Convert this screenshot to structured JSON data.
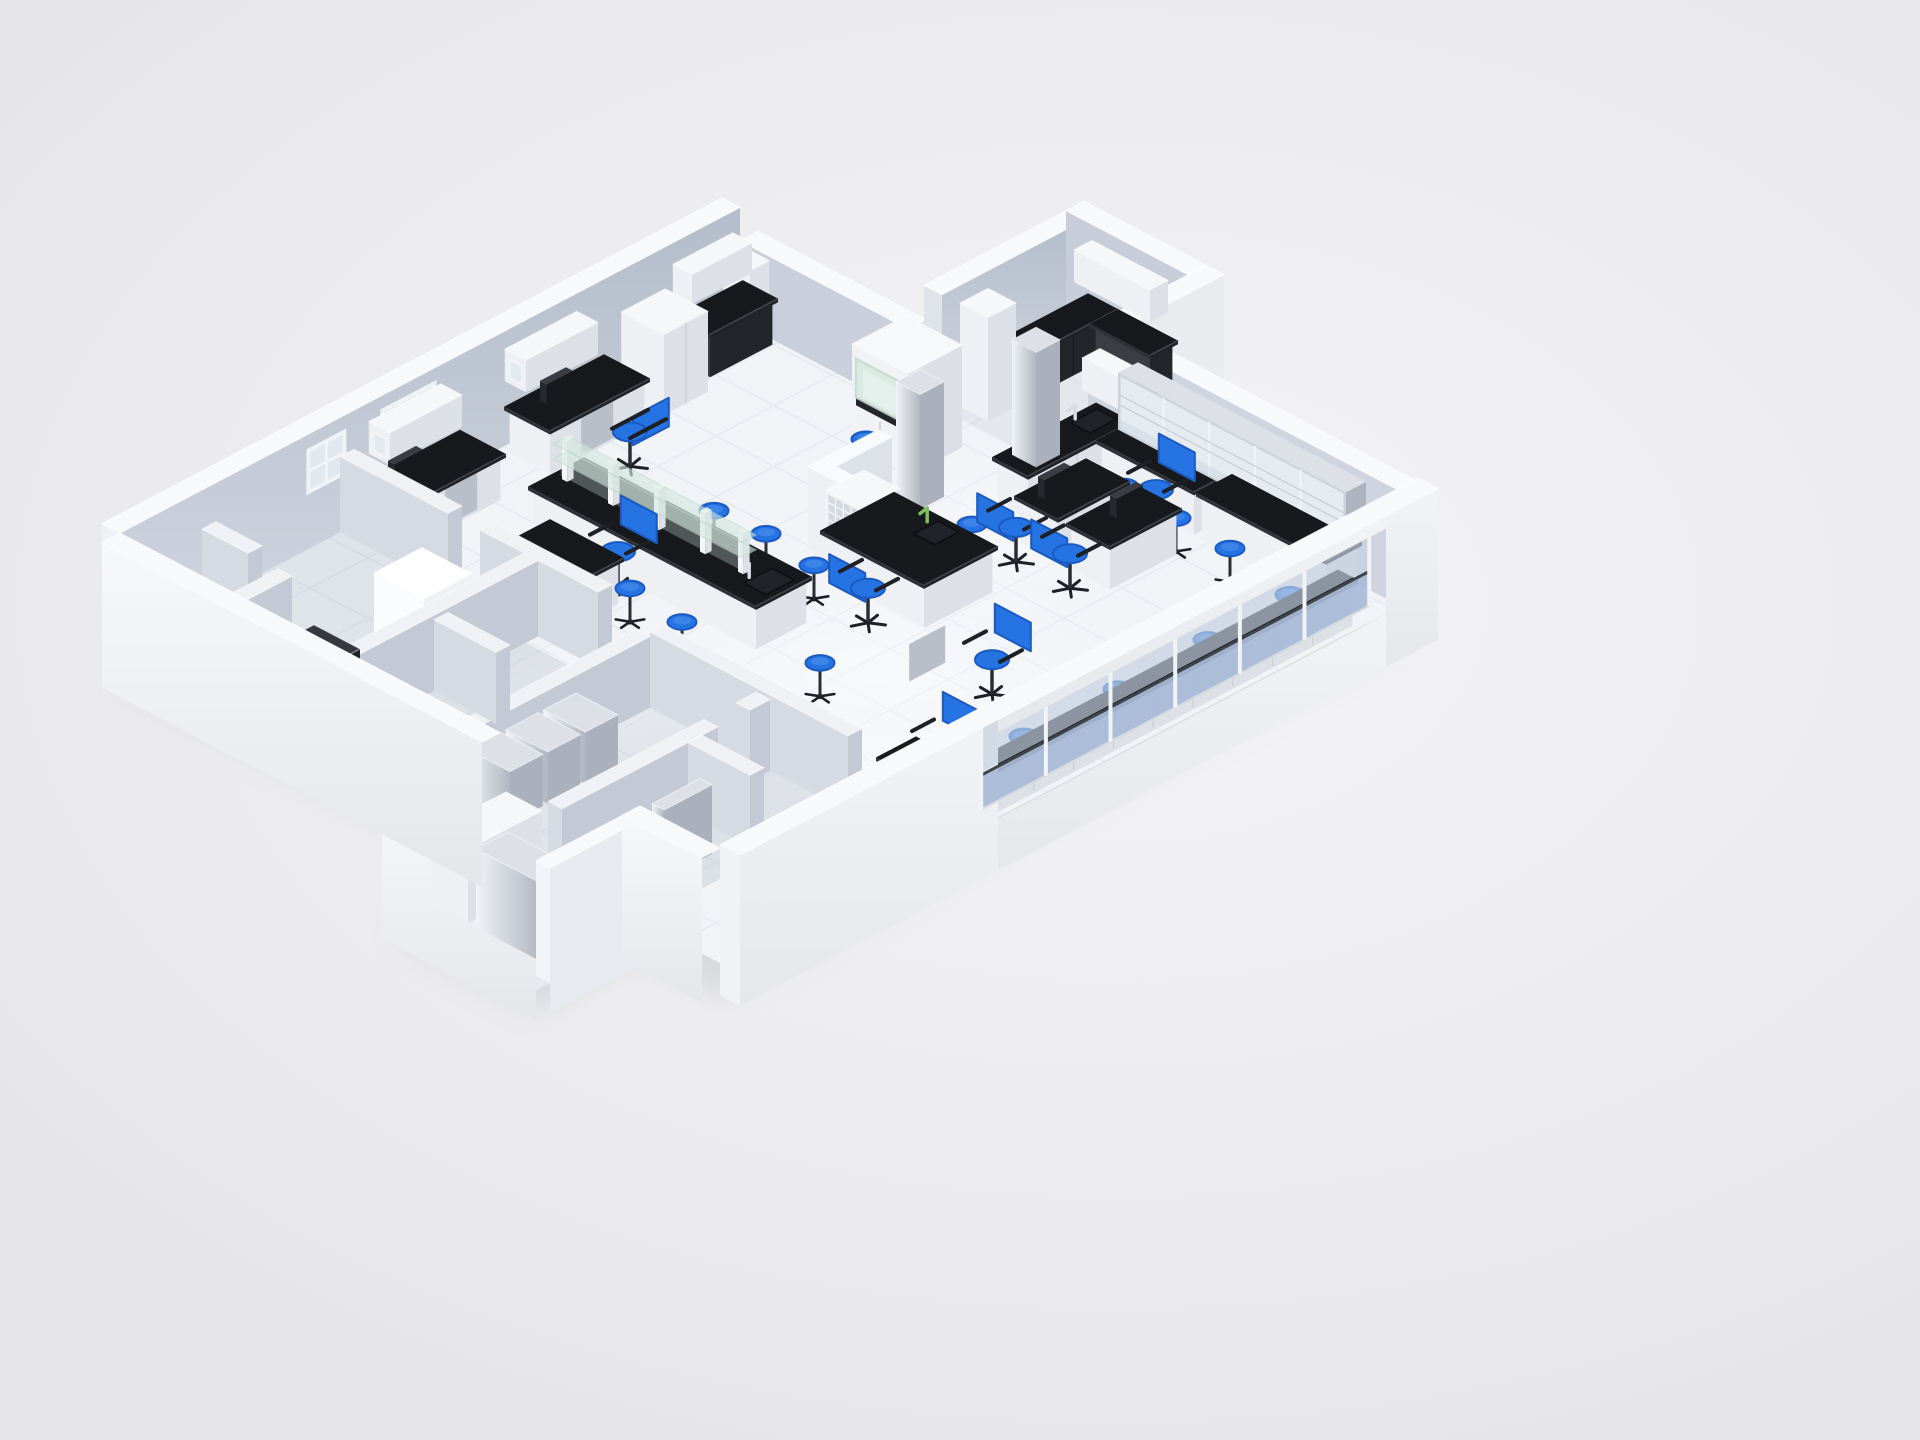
{
  "meta": {
    "title": "3D isometric laboratory floor plan render",
    "description": "Cutaway axonometric rendering of a laboratory: white outer walls, blue-gray partition walls, white tiled floor, black-top lab benches with white cabinets, central island with glass reagent shelf, fume hood, blue task chairs and blue round stools, glass curtain wall along the front facade, glass-door cabinet wall on the right."
  },
  "palette": {
    "bg": "#ededef",
    "shadow": "#c7c9ce",
    "floor": "#f1f3f7",
    "tile": "#e3e7ef",
    "wallTop": "#f8f9fb",
    "wallInnerA": "#b4bdcb",
    "wallInnerB": "#d0d6e0",
    "wallInnerNE": "#cfd5e0",
    "wallOuterBright": "#f5f6f8",
    "wallOuterShade": "#e4e7ec",
    "partU": "#d6dbe3",
    "partV": "#c3cad5",
    "partTop": "#eff1f5",
    "cabU": "#eef0f3",
    "cabV": "#dde1e7",
    "cabTop": "#f5f7f9",
    "cabLine": "#c9cdd4",
    "counterTop": "#17191c",
    "counterU": "#2e3237",
    "counterV": "#1f2226",
    "darkBase": "#33373d",
    "blue": "#2673e3",
    "blueDark": "#1b5ac0",
    "blueLight": "#5b99f0",
    "black": "#1d2024",
    "metalU": "#e9edf2",
    "metalV": "#aab1bc",
    "metalTop": "#dde0e6",
    "glassGreen": "#d6e9e0",
    "glassGreenEdge": "#bcd8cc",
    "glassUpper": "#c3cedf",
    "glassLower": "#a8bad7",
    "railDark": "#3f444b",
    "mullion": "#f1f3f6",
    "windowPane": "#e2ebf2",
    "red": "#c03a2b",
    "faucetGreen": "#7cc15a"
  },
  "iso": {
    "origin": [
      120,
      648
    ],
    "ax": 40,
    "ay": 21,
    "hz": 23
  },
  "scene": {
    "floor_outline": [
      [
        0,
        0
      ],
      [
        15.5,
        0
      ],
      [
        15.5,
        4.2
      ],
      [
        19.5,
        4.2
      ],
      [
        19.5,
        7.2
      ],
      [
        17,
        7.2
      ],
      [
        17,
        15
      ],
      [
        0,
        15
      ],
      [
        0,
        13
      ],
      [
        -2.6,
        13
      ],
      [
        -2.6,
        9.5
      ],
      [
        0,
        9.5
      ]
    ],
    "tile_step": 1.45,
    "room_shade": [
      {
        "n": "room-upper-left",
        "bb": [
          0,
          0,
          5.5,
          4.6
        ],
        "op": 0.2
      },
      {
        "n": "room-mid-left",
        "bb": [
          0,
          4.95,
          5.2,
          7.7
        ],
        "op": 0.24
      },
      {
        "n": "room-low-left-a",
        "bb": [
          0,
          8.05,
          5.2,
          10.7
        ],
        "op": 0.18
      },
      {
        "n": "room-low-left-b",
        "bb": [
          0,
          11.05,
          5.2,
          13.0
        ],
        "op": 0.24
      },
      {
        "n": "block-room",
        "bb": [
          -2.6,
          9.85,
          0,
          13.0
        ],
        "op": 0.22
      },
      {
        "n": "wing-room",
        "bb": [
          15.95,
          4.6,
          19.5,
          7.2
        ],
        "op": 0.14
      }
    ],
    "light_patches": [
      {
        "u": 4.6,
        "v": 7.1,
        "rx": 130,
        "ry": 60,
        "op": 0.65
      },
      {
        "u": 8.8,
        "v": 10.2,
        "rx": 300,
        "ry": 120,
        "op": 0.5
      },
      {
        "u": 13.5,
        "v": 8.2,
        "rx": 230,
        "ry": 95,
        "op": 0.32
      },
      {
        "u": 6.4,
        "v": 12.6,
        "rx": 150,
        "ry": 65,
        "op": 0.5
      }
    ],
    "walls_back": [
      {
        "n": "nw-wall",
        "bb": [
          0,
          -0.45,
          15.5,
          0
        ],
        "h": 5,
        "inner": "V",
        "fill": "GRADWALL",
        "capU0out": true
      },
      {
        "n": "notch-step-wall",
        "bb": [
          15.5,
          0,
          15.95,
          4.2
        ],
        "h": 3.55,
        "inner": "U",
        "fill": "#c9d0db",
        "capVend": "#dde1e7"
      },
      {
        "n": "wing-back-wall",
        "bb": [
          15.95,
          4.15,
          19.5,
          4.6
        ],
        "h": 5,
        "inner": "V",
        "fill": "GRADWALL",
        "capU0": "#e0e4ea"
      },
      {
        "n": "wing-far-wall",
        "bb": [
          19.5,
          4.15,
          19.95,
          7.65
        ],
        "h": 5,
        "inner": "U",
        "fill": "#c7ceda"
      },
      {
        "n": "wing-right-wall",
        "bb": [
          17.45,
          7.2,
          19.95,
          7.65
        ],
        "h": 5,
        "outerV": "#e9ebef",
        "capU0": "#dfe3e9"
      },
      {
        "n": "ne-wall",
        "bb": [
          17,
          7.2,
          17.45,
          15
        ],
        "h": 5,
        "inner": "U",
        "fill": "#cfd5e0",
        "capVend": "#e4e7ec"
      },
      {
        "n": "block-back-wall",
        "bb": [
          -2.6,
          9.5,
          0,
          9.85
        ],
        "h": 5,
        "inner": "V",
        "fill": "#c6cdd8"
      },
      {
        "n": "block-far-wall",
        "bb": [
          -2.95,
          9.5,
          -2.6,
          13.35
        ],
        "h": 5,
        "outerU": "GRADOUT",
        "capVend": "#e6e9ed"
      }
    ],
    "windows": [
      {
        "n": "nw-window-1",
        "u0": 4.7,
        "u1": 5.6,
        "h0": 2.5,
        "h1": 4.3,
        "cols": 2,
        "rows": 2
      },
      {
        "n": "nw-window-2",
        "u0": 6.55,
        "u1": 7.85,
        "h0": 2.55,
        "h1": 4.35,
        "cols": 3,
        "rows": 2
      },
      {
        "n": "alcove-window",
        "u0": 14.05,
        "u1": 14.75,
        "h0": 2.7,
        "h1": 3.9,
        "cols": 1,
        "rows": 1
      }
    ],
    "ne_monitor": {
      "v0": 7.5,
      "v1": 8.05,
      "h0": 3.35,
      "h1": 3.95
    },
    "items": [
      {
        "n": "partition-a",
        "t": "part",
        "bb": [
          0,
          4.6,
          5.5,
          4.95
        ],
        "h": 3.3
      },
      {
        "n": "partition-b1",
        "t": "part",
        "bb": [
          5.5,
          0,
          5.85,
          2.7
        ],
        "h": 3.3
      },
      {
        "n": "partition-b2",
        "t": "part",
        "bb": [
          5.5,
          3.5,
          5.85,
          6.45
        ],
        "h": 3.3
      },
      {
        "n": "partition-c",
        "t": "part",
        "bb": [
          0,
          7.7,
          5.2,
          8.05
        ],
        "h": 3.1
      },
      {
        "n": "partition-d",
        "t": "part",
        "bb": [
          5.2,
          8.05,
          5.55,
          13.0
        ],
        "h": 3.3
      },
      {
        "n": "partition-e1",
        "t": "part",
        "bb": [
          0,
          10.7,
          3.9,
          11.05
        ],
        "h": 3.1
      },
      {
        "n": "partition-e2",
        "t": "part",
        "bb": [
          4.7,
          10.7,
          5.2,
          11.05
        ],
        "h": 3.1
      },
      {
        "n": "partition-f",
        "t": "part",
        "bb": [
          2.9,
          4.95,
          3.25,
          6.5
        ],
        "h": 3.1
      },
      {
        "n": "partition-g",
        "t": "part",
        "bb": [
          3.15,
          11.05,
          3.5,
          12.6
        ],
        "h": 3.1
      },
      {
        "n": "partition-h",
        "t": "part",
        "bb": [
          2.05,
          0,
          2.4,
          1.15
        ],
        "h": 3.3
      },
      {
        "n": "partition-i",
        "t": "part",
        "bb": [
          0,
          1.9,
          2.05,
          2.25
        ],
        "h": 3.3
      },
      {
        "n": "tall-cabinet-left",
        "t": "box",
        "bb": [
          3.05,
          3.3,
          4.25,
          4.55
        ],
        "h": 3.5,
        "c": "bright"
      },
      {
        "n": "dark-equipment",
        "t": "box",
        "bb": [
          0.55,
          3.35,
          1.5,
          4.5
        ],
        "h": 2.7,
        "c": "dark",
        "reddot": true
      },
      {
        "n": "silver-cabinet-1",
        "t": "box",
        "bb": [
          0.7,
          8.0,
          1.52,
          9.05
        ],
        "h": 2.25,
        "c": "metal"
      },
      {
        "n": "silver-cabinet-2",
        "t": "box",
        "bb": [
          1.64,
          8.0,
          2.46,
          9.05
        ],
        "h": 2.25,
        "c": "metal"
      },
      {
        "n": "silver-cabinet-3",
        "t": "box",
        "bb": [
          2.58,
          8.0,
          3.4,
          9.05
        ],
        "h": 2.25,
        "c": "metal"
      },
      {
        "n": "leaning-panel-1",
        "t": "box",
        "bb": [
          2.1,
          11.0,
          3.3,
          11.3
        ],
        "h": 3.3,
        "c": "metal"
      },
      {
        "n": "leaning-panel-2",
        "t": "box",
        "bb": [
          1.3,
          12.0,
          2.5,
          12.3
        ],
        "h": 3.0,
        "c": "metal"
      },
      {
        "n": "gray-box",
        "t": "box",
        "bb": [
          0.4,
          5.2,
          1.2,
          6.2
        ],
        "h": 1.9,
        "c": "dark"
      },
      {
        "n": "block-cabinet-1",
        "t": "box",
        "bb": [
          -2.2,
          10.0,
          -0.35,
          10.9
        ],
        "h": 3.2,
        "c": "white"
      },
      {
        "n": "block-cabinet-2",
        "t": "box",
        "bb": [
          -2.2,
          11.1,
          -1.4,
          12.7
        ],
        "h": 3.4,
        "c": "metal"
      },
      {
        "n": "wall-bench-a",
        "t": "counter",
        "bb": [
          5.9,
          0.15,
          8.35,
          1.3
        ],
        "monitor": [
          6.25,
          0.45,
          6.95,
          0.62
        ],
        "gap": [
          6.9,
          7.7
        ]
      },
      {
        "n": "wall-bench-b",
        "t": "counter",
        "bb": [
          9.45,
          0.15,
          11.95,
          1.3
        ],
        "monitor": [
          10.05,
          0.45,
          10.7,
          0.62
        ],
        "gap": [
          10.3,
          11.1
        ]
      },
      {
        "n": "upper-cabinet-1",
        "t": "box",
        "bb": [
          6.2,
          0.02,
          8.0,
          0.55
        ],
        "h": 4.2,
        "z0": 2.8,
        "c": "white",
        "frost": true
      },
      {
        "n": "upper-cabinet-2",
        "t": "box",
        "bb": [
          9.6,
          0.02,
          11.4,
          0.55
        ],
        "h": 4.25,
        "z0": 2.85,
        "c": "white",
        "frost": true
      },
      {
        "n": "upper-cabinet-3",
        "t": "box",
        "bb": [
          13.8,
          0.02,
          15.3,
          0.5
        ],
        "h": 4.1,
        "z0": 2.8,
        "c": "white"
      },
      {
        "n": "tall-cabinet-2",
        "t": "box",
        "bb": [
          12.35,
          0.18,
          13.45,
          1.25
        ],
        "h": 3.5,
        "c": "white",
        "seam": true
      },
      {
        "n": "alcove-counter",
        "t": "counter",
        "bb": [
          13.75,
          0.12,
          15.45,
          1.0
        ],
        "dark": true
      },
      {
        "n": "alcove-pillar",
        "t": "box",
        "bb": [
          15.0,
          0.08,
          15.48,
          0.75
        ],
        "h": 3.4,
        "c": "white"
      },
      {
        "n": "fume-hood",
        "t": "hood",
        "bb": [
          13.95,
          4.35,
          15.3,
          5.75
        ],
        "h": 4.45
      },
      {
        "n": "column-1",
        "t": "box",
        "bb": [
          13.3,
          6.1,
          13.9,
          6.7
        ],
        "h": 5,
        "c": "metal"
      },
      {
        "n": "column-2",
        "t": "box",
        "bb": [
          15.75,
          6.55,
          16.35,
          7.15
        ],
        "h": 5,
        "c": "metal"
      },
      {
        "n": "white-column-cabinet",
        "t": "box",
        "bb": [
          16.25,
          4.75,
          16.95,
          5.45
        ],
        "h": 4.5,
        "c": "white"
      },
      {
        "n": "l-partition-1",
        "t": "part",
        "bb": [
          10.95,
          6.25,
          11.3,
          8.7
        ],
        "h": 3.6,
        "bright": true
      },
      {
        "n": "l-partition-2",
        "t": "part",
        "bb": [
          10.95,
          6.25,
          12.7,
          6.6
        ],
        "h": 3.6,
        "bright": true
      },
      {
        "n": "island-bench-1",
        "t": "island",
        "bb": [
          7.85,
          2.35,
          9.25,
          8.05
        ],
        "glass": [
          8.4,
          8.64,
          2.5,
          7.2
        ],
        "posts": [
          2.6,
          3.75,
          4.9,
          6.05,
          7.0
        ],
        "shelves": [
          2.9,
          3.55
        ],
        "sink": [
          8.25,
          7.35,
          8.95,
          7.9
        ],
        "faucet": [
          8.45,
          7.28
        ]
      },
      {
        "n": "desk-two-seat",
        "t": "counter",
        "bb": [
          6.15,
          3.4,
          7.35,
          5.25
        ]
      },
      {
        "n": "island-bench-2",
        "t": "counter",
        "bb": [
          10.45,
          7.05,
          12.3,
          9.65
        ],
        "sink": [
          11.55,
          8.3,
          12.15,
          8.82
        ],
        "faucetG": [
          12.0,
          8.18
        ]
      },
      {
        "n": "cubby-shelf",
        "t": "cubby",
        "bb": [
          10.55,
          7.1,
          11.5,
          8.0
        ],
        "z0": 2.04,
        "h": 3.72
      },
      {
        "n": "desk-right-a",
        "t": "counter",
        "bb": [
          13.7,
          8.65,
          15.5,
          9.75
        ],
        "monitor": [
          14.0,
          8.95,
          14.65,
          9.12
        ]
      },
      {
        "n": "desk-right-b",
        "t": "counter",
        "bb": [
          13.7,
          9.95,
          15.5,
          11.05
        ],
        "monitor": [
          14.45,
          10.3,
          15.1,
          10.47
        ]
      },
      {
        "n": "ne-bench-corner",
        "t": "counter",
        "bb": [
          14.35,
          7.45,
          16.95,
          8.35
        ],
        "sink": [
          16.15,
          7.62,
          16.8,
          8.1
        ],
        "faucet": [
          16.3,
          7.58
        ]
      },
      {
        "n": "ne-bench-long",
        "t": "counter",
        "bb": [
          16.05,
          8.35,
          16.95,
          10.8
        ],
        "gap": [
          9.0,
          9.9
        ]
      },
      {
        "n": "ne-bench-far",
        "t": "counter",
        "bb": [
          16.05,
          10.85,
          16.95,
          14.1
        ]
      },
      {
        "n": "glass-cabinet-wall",
        "t": "glasscab",
        "bb": [
          16.5,
          8.45,
          17.0,
          14.15
        ],
        "z0": 2.15,
        "h": 4.62
      },
      {
        "n": "ne-upper-cabinet",
        "t": "box",
        "bb": [
          16.55,
          7.5,
          17.0,
          8.4
        ],
        "h": 4.35,
        "z0": 2.95,
        "c": "white"
      },
      {
        "n": "wing-counter-1",
        "t": "counter",
        "bb": [
          17.35,
          4.75,
          19.45,
          5.5
        ],
        "dark": true
      },
      {
        "n": "wing-counter-2",
        "t": "counter",
        "bb": [
          18.75,
          5.5,
          19.45,
          7.0
        ],
        "dark": true
      },
      {
        "n": "wing-upper-cabinet",
        "t": "box",
        "bb": [
          19.05,
          4.8,
          19.5,
          6.7
        ],
        "h": 4.3,
        "z0": 2.9,
        "c": "white"
      },
      {
        "n": "front-desk",
        "t": "counter",
        "bb": [
          5.75,
          13.15,
          6.75,
          13.8
        ],
        "dark": true
      },
      {
        "n": "front-window-bench",
        "t": "counter",
        "bb": [
          6.9,
          14.45,
          16.0,
          14.95
        ]
      }
    ],
    "stools": [
      [
        7.2,
        4.5
      ],
      [
        7.0,
        5.75
      ],
      [
        6.85,
        7.2
      ],
      [
        9.9,
        4.95
      ],
      [
        10.0,
        6.15
      ],
      [
        9.85,
        7.5
      ],
      [
        13.5,
        5.15
      ],
      [
        12.8,
        8.5
      ],
      [
        14.35,
        8.78
      ],
      [
        15.6,
        9.5
      ],
      [
        15.5,
        10.9
      ],
      [
        15.45,
        12.3
      ],
      [
        7.6,
        9.9
      ],
      [
        8.4,
        14.2
      ],
      [
        10.7,
        14.25
      ],
      [
        13.0,
        14.2
      ],
      [
        15.1,
        14.15
      ]
    ],
    "chairs": [
      [
        10.7,
        2.05,
        "-v"
      ],
      [
        7.65,
        3.85,
        "-u"
      ],
      [
        7.7,
        4.75,
        "-u"
      ],
      [
        9.95,
        8.75,
        "+u"
      ],
      [
        13.25,
        9.15,
        "+u"
      ],
      [
        13.3,
        10.45,
        "+u"
      ],
      [
        15.9,
        10.0,
        "-u"
      ],
      [
        7.05,
        13.45,
        "-u"
      ],
      [
        9.8,
        12.0,
        "-u"
      ]
    ],
    "walls_front": [
      {
        "n": "sw-wall-a",
        "bb": [
          -0.45,
          0,
          0,
          9.5
        ],
        "h": 5,
        "outerU": "GRADOUT"
      },
      {
        "n": "block-front-wall",
        "bb": [
          -2.6,
          13,
          0,
          13.35
        ],
        "h": 5,
        "outerV": "#e7eaee",
        "capU0": "#f2f4f6"
      },
      {
        "n": "sw-wall-b",
        "bb": [
          -0.45,
          13,
          0,
          15
        ],
        "h": 5,
        "outerU": "GRADOUT"
      }
    ],
    "front_wall": {
      "v": 15,
      "thick": 0.5,
      "u0": 0,
      "u1": 17.45,
      "glass_u0": 6.45,
      "glass_u1": 16.15,
      "panels": 6,
      "sill_h": 0.85,
      "low_top": 2.35,
      "rail_top": 2.5,
      "glass_top": 4.45,
      "beam_top": 5.15
    }
  }
}
